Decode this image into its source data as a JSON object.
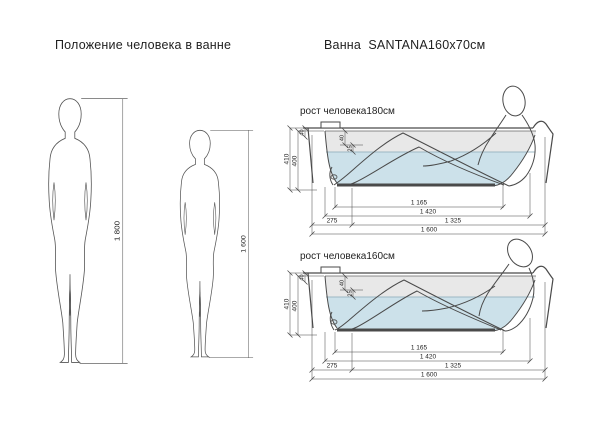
{
  "page": {
    "background": "#ffffff"
  },
  "left_section": {
    "title": "Положение человека в ванне",
    "figures": [
      {
        "name": "person-180",
        "height_label": "1 800"
      },
      {
        "name": "person-160",
        "height_label": "1 600"
      }
    ]
  },
  "right_section": {
    "title": "Ванна  SANTANA160x70см",
    "diagrams": [
      {
        "caption": "рост человека180см",
        "dims": {
          "total_height": "410",
          "inner_depth": "400",
          "rim_height": "40",
          "rim_to_water_a": "40",
          "rim_to_water_b": "25",
          "bottom_length": "1 165",
          "mid_length": "1 420",
          "left_offset": "275",
          "right_length": "1 325",
          "total_length": "1 600"
        }
      },
      {
        "caption": "рост человека160см",
        "dims": {
          "total_height": "410",
          "inner_depth": "400",
          "rim_height": "40",
          "rim_to_water_a": "40",
          "rim_to_water_b": "25",
          "bottom_length": "1 165",
          "mid_length": "1 420",
          "left_offset": "275",
          "right_length": "1 325",
          "total_length": "1 600"
        }
      }
    ]
  },
  "colors": {
    "water": "#cce1ea",
    "above_water_band": "#e8e8e8",
    "outline": "#4a4a4a",
    "dimension_lines": "#444444"
  }
}
